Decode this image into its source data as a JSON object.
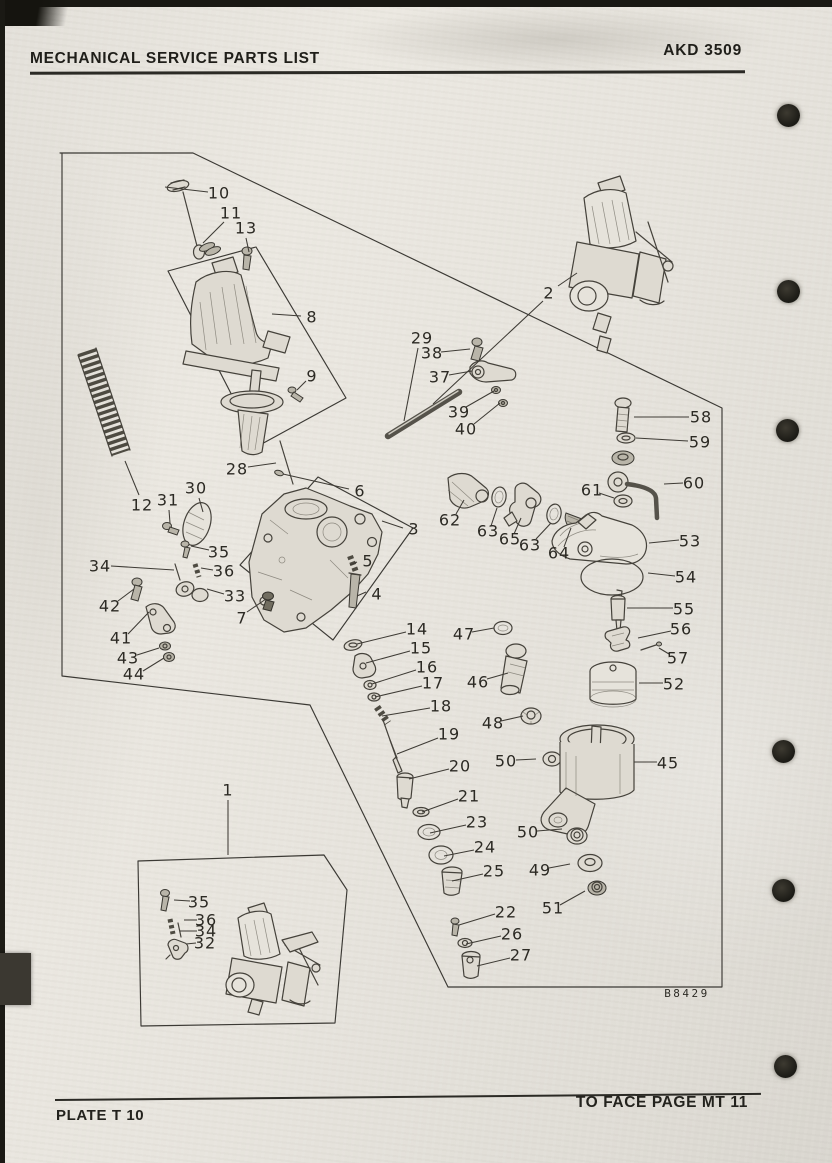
{
  "page": {
    "paper_color": "#e9e6df",
    "ink_color": "#2c2a25",
    "punch_holes": [
      {
        "x": 788,
        "y": 115
      },
      {
        "x": 788,
        "y": 291
      },
      {
        "x": 787,
        "y": 430
      },
      {
        "x": 783,
        "y": 751
      },
      {
        "x": 783,
        "y": 890
      },
      {
        "x": 785,
        "y": 1066
      }
    ]
  },
  "header": {
    "title": "MECHANICAL SERVICE PARTS LIST",
    "doc_number": "AKD 3509"
  },
  "footer": {
    "plate_label": "PLATE T 10",
    "facing_label": "TO FACE PAGE MT 11"
  },
  "diagram": {
    "figure_code": "B8429",
    "callouts": [
      {
        "n": "1",
        "x": 228,
        "y": 790,
        "x1": 228,
        "y1": 800,
        "x2": 228,
        "y2": 855
      },
      {
        "n": "2",
        "x": 549,
        "y": 293,
        "x1": 558,
        "y1": 286,
        "x2": 577,
        "y2": 273
      },
      {
        "n": "3",
        "x": 414,
        "y": 529,
        "x1": 403,
        "y1": 528,
        "x2": 382,
        "y2": 521
      },
      {
        "n": "4",
        "x": 377,
        "y": 594,
        "x1": 366,
        "y1": 592,
        "x2": 357,
        "y2": 596
      },
      {
        "n": "5",
        "x": 368,
        "y": 561,
        "x1": 357,
        "y1": 562,
        "x2": 350,
        "y2": 565
      },
      {
        "n": "6",
        "x": 360,
        "y": 491,
        "x1": 349,
        "y1": 489,
        "x2": 283,
        "y2": 474
      },
      {
        "n": "7",
        "x": 242,
        "y": 618,
        "x1": 247,
        "y1": 612,
        "x2": 266,
        "y2": 599
      },
      {
        "n": "8",
        "x": 312,
        "y": 317,
        "x1": 301,
        "y1": 316,
        "x2": 272,
        "y2": 314
      },
      {
        "n": "9",
        "x": 312,
        "y": 376,
        "x1": 306,
        "y1": 381,
        "x2": 297,
        "y2": 390
      },
      {
        "n": "10",
        "x": 219,
        "y": 193,
        "x1": 208,
        "y1": 192,
        "x2": 165,
        "y2": 187
      },
      {
        "n": "11",
        "x": 231,
        "y": 213,
        "x1": 224,
        "y1": 222,
        "x2": 203,
        "y2": 243
      },
      {
        "n": "12",
        "x": 142,
        "y": 505,
        "x1": 139,
        "y1": 495,
        "x2": 125,
        "y2": 461
      },
      {
        "n": "13",
        "x": 246,
        "y": 228,
        "x1": 246,
        "y1": 238,
        "x2": 249,
        "y2": 252
      },
      {
        "n": "14",
        "x": 417,
        "y": 629,
        "x1": 406,
        "y1": 632,
        "x2": 357,
        "y2": 644
      },
      {
        "n": "15",
        "x": 421,
        "y": 648,
        "x1": 410,
        "y1": 651,
        "x2": 366,
        "y2": 663
      },
      {
        "n": "16",
        "x": 427,
        "y": 667,
        "x1": 416,
        "y1": 670,
        "x2": 372,
        "y2": 684
      },
      {
        "n": "17",
        "x": 433,
        "y": 683,
        "x1": 422,
        "y1": 686,
        "x2": 375,
        "y2": 697
      },
      {
        "n": "18",
        "x": 441,
        "y": 706,
        "x1": 430,
        "y1": 708,
        "x2": 382,
        "y2": 716
      },
      {
        "n": "19",
        "x": 449,
        "y": 734,
        "x1": 438,
        "y1": 738,
        "x2": 397,
        "y2": 754
      },
      {
        "n": "20",
        "x": 460,
        "y": 766,
        "x1": 449,
        "y1": 769,
        "x2": 409,
        "y2": 779
      },
      {
        "n": "21",
        "x": 469,
        "y": 796,
        "x1": 458,
        "y1": 799,
        "x2": 422,
        "y2": 812
      },
      {
        "n": "22",
        "x": 506,
        "y": 912,
        "x1": 495,
        "y1": 914,
        "x2": 459,
        "y2": 925
      },
      {
        "n": "23",
        "x": 477,
        "y": 822,
        "x1": 466,
        "y1": 825,
        "x2": 430,
        "y2": 833
      },
      {
        "n": "24",
        "x": 485,
        "y": 847,
        "x1": 474,
        "y1": 850,
        "x2": 444,
        "y2": 856
      },
      {
        "n": "25",
        "x": 494,
        "y": 871,
        "x1": 483,
        "y1": 874,
        "x2": 452,
        "y2": 881
      },
      {
        "n": "26",
        "x": 512,
        "y": 934,
        "x1": 501,
        "y1": 936,
        "x2": 466,
        "y2": 944
      },
      {
        "n": "27",
        "x": 521,
        "y": 955,
        "x1": 510,
        "y1": 958,
        "x2": 477,
        "y2": 966
      },
      {
        "n": "28",
        "x": 237,
        "y": 469,
        "x1": 248,
        "y1": 467,
        "x2": 276,
        "y2": 463
      },
      {
        "n": "29",
        "x": 422,
        "y": 338,
        "x1": 418,
        "y1": 348,
        "x2": 404,
        "y2": 421
      },
      {
        "n": "30",
        "x": 196,
        "y": 488,
        "x1": 199,
        "y1": 498,
        "x2": 203,
        "y2": 512
      },
      {
        "n": "31",
        "x": 168,
        "y": 500,
        "x1": 169,
        "y1": 510,
        "x2": 170,
        "y2": 523
      },
      {
        "n": "32",
        "x": 205,
        "y": 943,
        "x1": 196,
        "y1": 943,
        "x2": 186,
        "y2": 944
      },
      {
        "n": "33",
        "x": 235,
        "y": 596,
        "x1": 224,
        "y1": 594,
        "x2": 207,
        "y2": 589
      },
      {
        "n": "34",
        "x": 100,
        "y": 566,
        "x1": 111,
        "y1": 566,
        "x2": 174,
        "y2": 570
      },
      {
        "n": "34",
        "x": 206,
        "y": 931,
        "x1": 197,
        "y1": 931,
        "x2": 180,
        "y2": 931
      },
      {
        "n": "35",
        "x": 219,
        "y": 552,
        "x1": 209,
        "y1": 550,
        "x2": 191,
        "y2": 546
      },
      {
        "n": "35",
        "x": 199,
        "y": 902,
        "x1": 190,
        "y1": 901,
        "x2": 174,
        "y2": 900
      },
      {
        "n": "36",
        "x": 224,
        "y": 571,
        "x1": 213,
        "y1": 570,
        "x2": 201,
        "y2": 568
      },
      {
        "n": "36",
        "x": 206,
        "y": 920,
        "x1": 197,
        "y1": 920,
        "x2": 184,
        "y2": 920
      },
      {
        "n": "37",
        "x": 440,
        "y": 377,
        "x1": 449,
        "y1": 375,
        "x2": 472,
        "y2": 371
      },
      {
        "n": "38",
        "x": 432,
        "y": 353,
        "x1": 441,
        "y1": 352,
        "x2": 470,
        "y2": 349
      },
      {
        "n": "39",
        "x": 459,
        "y": 412,
        "x1": 466,
        "y1": 407,
        "x2": 494,
        "y2": 391
      },
      {
        "n": "40",
        "x": 466,
        "y": 429,
        "x1": 474,
        "y1": 424,
        "x2": 500,
        "y2": 403
      },
      {
        "n": "41",
        "x": 121,
        "y": 638,
        "x1": 128,
        "y1": 634,
        "x2": 149,
        "y2": 612
      },
      {
        "n": "42",
        "x": 110,
        "y": 606,
        "x1": 118,
        "y1": 601,
        "x2": 134,
        "y2": 589
      },
      {
        "n": "43",
        "x": 128,
        "y": 658,
        "x1": 137,
        "y1": 655,
        "x2": 159,
        "y2": 648
      },
      {
        "n": "44",
        "x": 134,
        "y": 674,
        "x1": 143,
        "y1": 671,
        "x2": 164,
        "y2": 658
      },
      {
        "n": "45",
        "x": 668,
        "y": 763,
        "x1": 657,
        "y1": 762,
        "x2": 634,
        "y2": 762
      },
      {
        "n": "46",
        "x": 478,
        "y": 682,
        "x1": 487,
        "y1": 679,
        "x2": 508,
        "y2": 673
      },
      {
        "n": "47",
        "x": 464,
        "y": 634,
        "x1": 472,
        "y1": 632,
        "x2": 494,
        "y2": 628
      },
      {
        "n": "48",
        "x": 493,
        "y": 723,
        "x1": 501,
        "y1": 721,
        "x2": 523,
        "y2": 716
      },
      {
        "n": "49",
        "x": 540,
        "y": 870,
        "x1": 549,
        "y1": 868,
        "x2": 570,
        "y2": 864
      },
      {
        "n": "50",
        "x": 506,
        "y": 761,
        "x1": 516,
        "y1": 760,
        "x2": 536,
        "y2": 759
      },
      {
        "n": "50",
        "x": 528,
        "y": 832,
        "x1": 537,
        "y1": 831,
        "x2": 562,
        "y2": 829
      },
      {
        "n": "51",
        "x": 553,
        "y": 908,
        "x1": 560,
        "y1": 905,
        "x2": 585,
        "y2": 891
      },
      {
        "n": "52",
        "x": 674,
        "y": 684,
        "x1": 663,
        "y1": 683,
        "x2": 639,
        "y2": 683
      },
      {
        "n": "53",
        "x": 690,
        "y": 541,
        "x1": 679,
        "y1": 540,
        "x2": 649,
        "y2": 543
      },
      {
        "n": "54",
        "x": 686,
        "y": 577,
        "x1": 675,
        "y1": 576,
        "x2": 648,
        "y2": 573
      },
      {
        "n": "55",
        "x": 684,
        "y": 609,
        "x1": 673,
        "y1": 608,
        "x2": 627,
        "y2": 608
      },
      {
        "n": "56",
        "x": 681,
        "y": 629,
        "x1": 671,
        "y1": 631,
        "x2": 638,
        "y2": 638
      },
      {
        "n": "57",
        "x": 678,
        "y": 658,
        "x1": 669,
        "y1": 654,
        "x2": 659,
        "y2": 648
      },
      {
        "n": "58",
        "x": 701,
        "y": 417,
        "x1": 689,
        "y1": 417,
        "x2": 634,
        "y2": 417
      },
      {
        "n": "59",
        "x": 700,
        "y": 442,
        "x1": 688,
        "y1": 441,
        "x2": 636,
        "y2": 438
      },
      {
        "n": "60",
        "x": 694,
        "y": 483,
        "x1": 683,
        "y1": 483,
        "x2": 664,
        "y2": 484
      },
      {
        "n": "61",
        "x": 592,
        "y": 490,
        "x1": 599,
        "y1": 493,
        "x2": 614,
        "y2": 498
      },
      {
        "n": "62",
        "x": 450,
        "y": 520,
        "x1": 456,
        "y1": 514,
        "x2": 464,
        "y2": 500
      },
      {
        "n": "63",
        "x": 488,
        "y": 531,
        "x1": 491,
        "y1": 526,
        "x2": 497,
        "y2": 508
      },
      {
        "n": "63",
        "x": 530,
        "y": 545,
        "x1": 536,
        "y1": 539,
        "x2": 551,
        "y2": 523
      },
      {
        "n": "64",
        "x": 559,
        "y": 553,
        "x1": 564,
        "y1": 547,
        "x2": 571,
        "y2": 528
      },
      {
        "n": "65",
        "x": 510,
        "y": 539,
        "x1": 514,
        "y1": 534,
        "x2": 521,
        "y2": 518
      }
    ],
    "extra_leader_lines": [
      {
        "x1": 543,
        "y1": 301,
        "x2": 433,
        "y2": 404
      }
    ]
  }
}
